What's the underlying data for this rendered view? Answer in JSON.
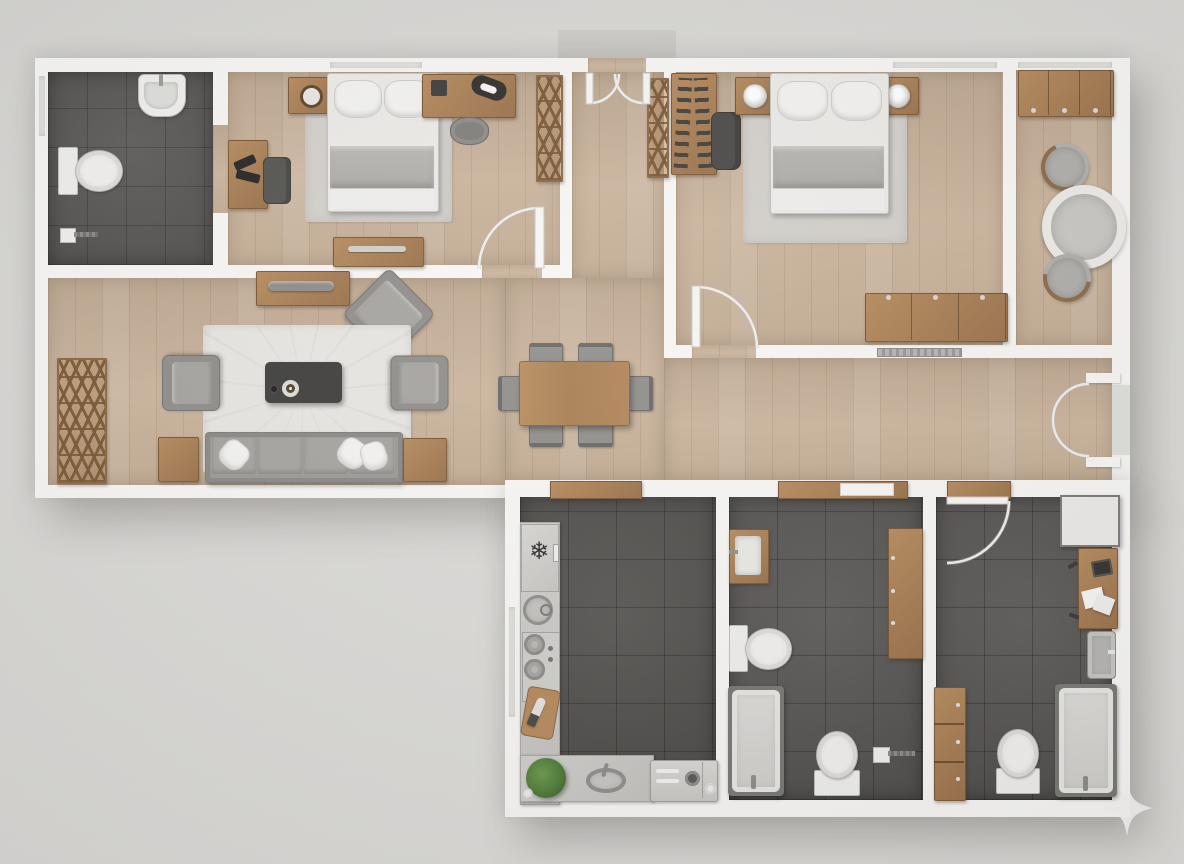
{
  "scene": {
    "title": "Top-down 3D rendered apartment floor plan",
    "canvas": {
      "width": 1184,
      "height": 864
    },
    "visible_text": "none"
  },
  "palette": {
    "background": "#d6d5d2",
    "backgroundEdge": "#dcdbd8",
    "wall": "#f7f6f4",
    "woodFloor": "#c8b198",
    "tileKitchen": "#514f4c",
    "tileBath": "#575553",
    "woodFurniture": "#a87e54",
    "counter": "#c9c8c5",
    "fabricGray": "#9b9995",
    "bedLinen": "#eceae7",
    "blanketGray": "#b8b6b2",
    "rugLight": "#e7e5e1",
    "rugBedroom": "#d3d0cb",
    "fixtureWhite": "#f0efed",
    "fixtureBorder": "#b9b8b5",
    "charcoal": "#3e3d3b",
    "plantGreen": "#55803d",
    "glass": "#dededb",
    "starWhite": "#f4f3f1"
  },
  "rooms": [
    {
      "id": "bathroom-1",
      "label": "bathroom top-left",
      "floor": "dark ceramic tile",
      "items": [
        "wall-hung sink",
        "toilet",
        "toilet brush",
        "window in left wall",
        "doorway to bedroom 1"
      ]
    },
    {
      "id": "bedroom-1",
      "label": "bedroom top-left",
      "floor": "oak plank",
      "items": [
        "double bed with gray blanket",
        "gray area rug",
        "nightstand with cup",
        "wall console with laptop and guitar",
        "gray stool",
        "work desk with papers",
        "desk chair",
        "chest of drawers",
        "ladder lattice shelf",
        "door with swing arc",
        "window"
      ]
    },
    {
      "id": "entry-hall",
      "label": "entry hall top-center",
      "floor": "oak plank",
      "items": [
        "double entry door with swing arcs",
        "lattice shoe cabinet"
      ]
    },
    {
      "id": "bedroom-2",
      "label": "master bedroom top-right",
      "floor": "oak plank",
      "items": [
        "double bed with gray blanket",
        "two nightstands with round lamps",
        "open wardrobe with hanging clothes",
        "desk chair",
        "area rug",
        "triple dresser",
        "wall radiator",
        "door with swing arc",
        "window"
      ]
    },
    {
      "id": "sitting-nook",
      "label": "balcony sitting nook far right",
      "floor": "oak plank",
      "items": [
        "three-door sideboard",
        "round lounge chair",
        "round table",
        "round lounge chair",
        "glazed top wall"
      ]
    },
    {
      "id": "living-room",
      "label": "living room left-center",
      "floor": "oak plank",
      "items": [
        "zigzag lattice shelf",
        "TV console with soundbar",
        "corner armchair rotated 45deg",
        "two facing armchairs",
        "white area rug",
        "dark coffee table with two plates",
        "four-seat sofa with three pillows",
        "two wooden side tables"
      ]
    },
    {
      "id": "dining-area",
      "label": "dining area center",
      "floor": "oak plank",
      "items": [
        "rectangular dining table",
        "six gray chairs"
      ]
    },
    {
      "id": "kitchen",
      "label": "kitchen bottom-left",
      "floor": "dark ceramic tile",
      "items": [
        "L-shaped counter",
        "refrigerator with snowflake mark",
        "round basin",
        "two-burner cooktop with knobs",
        "cutting board with knife",
        "potted plant in corner",
        "oval sink with faucet",
        "oven-washer unit with dials",
        "window in left wall",
        "open doorway"
      ]
    },
    {
      "id": "bathroom-2",
      "label": "family bathroom bottom-center",
      "floor": "dark ceramic tile",
      "items": [
        "wood-framed vanity sink",
        "toilet on left wall",
        "bathtub with shower",
        "second toilet facing up",
        "tall wooden cabinet",
        "toilet brush",
        "wide doorway with wood threshold"
      ]
    },
    {
      "id": "utility-bathroom",
      "label": "utility bathroom / office bottom-right",
      "floor": "dark ceramic tile",
      "items": [
        "white storage cabinet",
        "desk with laptop and papers",
        "wall-mounted gray sink",
        "bathtub",
        "toilet facing up",
        "three-drawer unit",
        "door with swing arc"
      ]
    },
    {
      "id": "corridor",
      "label": "corridor right of dining",
      "items": [
        "recessed double balcony door with swing arcs"
      ]
    }
  ],
  "decorations": [
    {
      "id": "sparkle",
      "label": "four-point sparkle watermark at bottom-right building corner"
    },
    {
      "id": "porch",
      "label": "gray entry pad above double entry door"
    }
  ]
}
